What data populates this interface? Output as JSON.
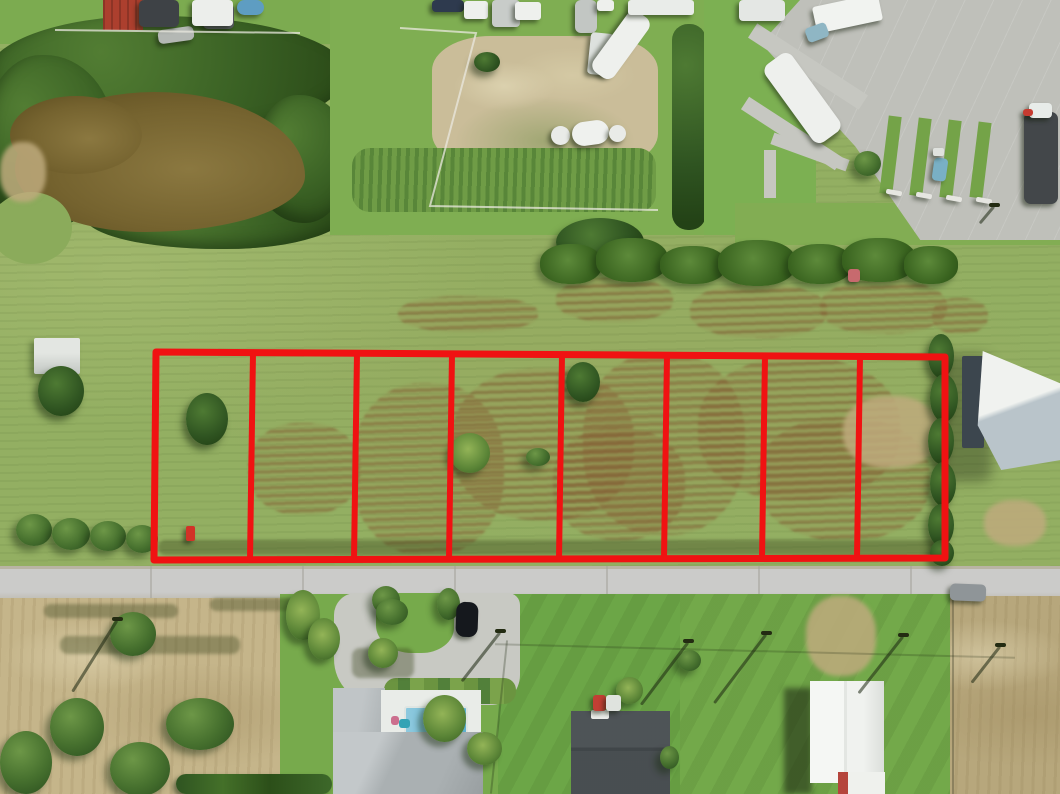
{
  "scene": {
    "subject": "aerial drone photo of grass acreage subdivided into outlined vacant lots along a street",
    "colors": {
      "grass_field": "#93af62",
      "grass_lawn": "#74a94a",
      "road": "#c9c9c6",
      "concrete": "#bfc0ba",
      "pond_water": "#7c6a34",
      "bare_dirt": "#cabd99",
      "dry_field": "#c5b58a",
      "overlay_red": "#f01212",
      "roof_gray": "#aeb3b5",
      "roof_dark": "#878c8f",
      "building_white": "#f2f4f1"
    },
    "overlay": {
      "lot_count": 8,
      "stroke_color": "#f01212",
      "stroke_width": 7,
      "divider_width": 6,
      "outline": {
        "tl": [
          156,
          352
        ],
        "tr": [
          945,
          357
        ],
        "br": [
          945,
          558
        ],
        "bl": [
          154,
          560
        ]
      },
      "divider_xs": [
        253,
        357,
        452,
        562,
        667,
        765,
        860
      ],
      "divider_lean": -3
    },
    "fences": {
      "color": "#e9e8df",
      "lines": [
        "400,28 476,33 430,206 658,210",
        "55,30 300,33"
      ]
    },
    "veg_fields": [
      "name",
      "type",
      "x",
      "y",
      "w",
      "h"
    ],
    "veg": [
      [
        "lot1-tree",
        "dark",
        186,
        393,
        42,
        52
      ],
      [
        "shed-tree",
        "dark",
        38,
        366,
        46,
        50
      ],
      [
        "roadside-bush-1",
        "bush",
        16,
        514,
        36,
        32
      ],
      [
        "roadside-bush-2",
        "bush",
        52,
        518,
        38,
        32
      ],
      [
        "roadside-bush-3",
        "bush",
        90,
        521,
        36,
        30
      ],
      [
        "roadside-bush-4",
        "bush",
        126,
        525,
        32,
        28
      ],
      [
        "lot4-palm",
        "palm",
        450,
        433,
        40,
        40
      ],
      [
        "lot4-bush",
        "bush",
        526,
        448,
        24,
        18
      ],
      [
        "lot5-tree",
        "dark",
        566,
        362,
        34,
        40
      ],
      [
        "hedgerow-tree",
        "dark",
        556,
        218,
        88,
        48
      ],
      [
        "hedgerow-1",
        "hedge",
        540,
        244,
        62,
        40
      ],
      [
        "hedgerow-2",
        "hedge",
        596,
        238,
        72,
        44
      ],
      [
        "hedgerow-3",
        "hedge",
        660,
        246,
        66,
        38
      ],
      [
        "hedgerow-4",
        "hedge",
        718,
        240,
        78,
        46
      ],
      [
        "hedgerow-5",
        "hedge",
        788,
        244,
        64,
        40
      ],
      [
        "hedgerow-6",
        "hedge",
        842,
        238,
        74,
        44
      ],
      [
        "hedgerow-7",
        "hedge",
        904,
        246,
        54,
        38
      ],
      [
        "right-hedge-1",
        "dark",
        928,
        334,
        26,
        44
      ],
      [
        "right-hedge-2",
        "dark",
        930,
        374,
        28,
        48
      ],
      [
        "right-hedge-3",
        "dark",
        928,
        418,
        26,
        46
      ],
      [
        "right-hedge-4",
        "dark",
        930,
        462,
        26,
        44
      ],
      [
        "right-hedge-5",
        "dark",
        928,
        504,
        26,
        42
      ],
      [
        "right-hedge-6",
        "dark",
        930,
        540,
        24,
        26
      ],
      [
        "bottomleft-tree",
        "bush",
        110,
        612,
        46,
        44
      ],
      [
        "bl-bush-1",
        "bush",
        50,
        698,
        54,
        58
      ],
      [
        "bl-bush-2",
        "bush",
        110,
        742,
        60,
        54
      ],
      [
        "bl-bush-3",
        "bush",
        0,
        731,
        52,
        63
      ],
      [
        "bl-bush-4",
        "bush",
        166,
        698,
        68,
        52
      ],
      [
        "bottom-hedgerow",
        "rowdark",
        176,
        774,
        156,
        20
      ],
      [
        "drive-palm-1",
        "palm",
        286,
        590,
        34,
        50
      ],
      [
        "drive-palm-2",
        "palm",
        308,
        618,
        32,
        42
      ],
      [
        "drive-bush-1",
        "bush",
        372,
        586,
        28,
        28
      ],
      [
        "drive-bush-2",
        "bush",
        437,
        588,
        23,
        32
      ],
      [
        "island-bush",
        "bush",
        376,
        599,
        32,
        26
      ],
      [
        "island-palm",
        "palm",
        368,
        638,
        30,
        30
      ],
      [
        "yard-palm-1",
        "palm",
        423,
        695,
        43,
        47
      ],
      [
        "yard-palm-2",
        "palm",
        467,
        732,
        35,
        33
      ],
      [
        "midyard-palm",
        "palm",
        616,
        677,
        27,
        27
      ],
      [
        "midyard-bush",
        "bush",
        660,
        746,
        19,
        23
      ],
      [
        "yard-bush-right",
        "bush",
        678,
        650,
        23,
        21
      ],
      [
        "topright-bush",
        "bush",
        854,
        151,
        27,
        25
      ],
      [
        "enclosure-bush",
        "dark",
        474,
        52,
        26,
        20
      ]
    ],
    "patch_fields": [
      "name",
      "type",
      "x",
      "y",
      "w",
      "h"
    ],
    "patches": [
      [
        "lot23-mow-scar",
        "brown",
        352,
        383,
        152,
        172
      ],
      [
        "lot34-mow-scar",
        "brown",
        452,
        368,
        182,
        152
      ],
      [
        "lot5-mow-scar",
        "brown",
        583,
        353,
        162,
        182
      ],
      [
        "lot67-mow-scar",
        "brown",
        698,
        358,
        202,
        142
      ],
      [
        "lot78-mow-scar",
        "brown",
        758,
        418,
        172,
        122
      ],
      [
        "lot45-mow-scar",
        "brown",
        553,
        428,
        132,
        112
      ],
      [
        "lot2-mow-scar",
        "brown",
        248,
        423,
        112,
        92
      ],
      [
        "lot8-bare-spot",
        "tan",
        843,
        396,
        96,
        72
      ],
      [
        "upper-scar-1",
        "brown",
        556,
        278,
        117,
        44
      ],
      [
        "upper-scar-2",
        "brown",
        690,
        284,
        137,
        54
      ],
      [
        "upper-scar-3",
        "brown",
        820,
        280,
        127,
        54
      ],
      [
        "upper-scar-4",
        "brown",
        932,
        298,
        56,
        36
      ],
      [
        "upper-scar-left",
        "brown",
        398,
        296,
        140,
        36
      ],
      [
        "worn-track",
        "dark",
        158,
        540,
        790,
        15
      ],
      [
        "dryfield-track-1",
        "dark",
        44,
        604,
        134,
        14
      ],
      [
        "dryfield-track-2",
        "dark",
        210,
        598,
        84,
        13
      ],
      [
        "dryfield-track-3",
        "dark",
        60,
        636,
        180,
        18
      ],
      [
        "gravel-drive-right",
        "tan",
        806,
        596,
        70,
        80
      ],
      [
        "righthouse-bare",
        "tan",
        984,
        500,
        62,
        46
      ],
      [
        "pond-bank",
        "tan",
        0,
        142,
        46,
        60
      ],
      [
        "drive-tree-shadow",
        "dark",
        352,
        648,
        62,
        30
      ]
    ],
    "vehicle_fields": [
      "name",
      "x",
      "y",
      "w",
      "h",
      "color",
      "rotation_deg",
      "corner_radius"
    ],
    "vehicles": [
      [
        "parked-black-car",
        456,
        602,
        22,
        35,
        "#15181d",
        2,
        9
      ],
      [
        "car-on-road",
        950,
        584,
        36,
        17,
        "#8f9598",
        2,
        5
      ],
      [
        "teal-cart",
        933,
        158,
        14,
        23,
        "#79b0c5",
        8,
        4
      ],
      [
        "dark-rv",
        1024,
        112,
        34,
        92,
        "#43474a",
        0,
        7
      ],
      [
        "dark-rv-cab",
        1029,
        103,
        23,
        15,
        "#e8ece9",
        0,
        4
      ],
      [
        "red-truck-cab",
        593,
        695,
        13,
        16,
        "#c23f34",
        0,
        3
      ],
      [
        "red-truck-bed",
        606,
        695,
        15,
        16,
        "#dfe3de",
        0,
        3
      ],
      [
        "blue-pool-top",
        237,
        0,
        27,
        15,
        "#5e9dc2",
        0,
        12
      ],
      [
        "gray-van",
        575,
        0,
        22,
        33,
        "#c2c6c3",
        0,
        6
      ],
      [
        "white-box-top",
        597,
        0,
        17,
        11,
        "#eef0ed",
        0,
        3
      ],
      [
        "boat-trailer",
        158,
        28,
        36,
        14,
        "#b4b8b4",
        -8,
        5
      ],
      [
        "yard-equipment-1",
        139,
        0,
        40,
        27,
        "#3e4246",
        0,
        5
      ],
      [
        "yard-equipment-2",
        203,
        4,
        31,
        25,
        "#55595d",
        0,
        5
      ],
      [
        "white-trailer-1",
        192,
        0,
        41,
        26,
        "#eceeeb",
        0,
        4
      ],
      [
        "dark-blue-rv",
        432,
        0,
        32,
        12,
        "#2e3a4e",
        0,
        4
      ],
      [
        "white-rv-1",
        464,
        1,
        24,
        18,
        "#eef0ed",
        0,
        3
      ],
      [
        "gray-rv",
        492,
        0,
        28,
        27,
        "#c8ccc9",
        0,
        4
      ],
      [
        "white-rv-2",
        515,
        2,
        26,
        18,
        "#eef0ed",
        0,
        3
      ],
      [
        "white-box-trailer",
        589,
        33,
        23,
        42,
        "#dde1de",
        6,
        4
      ],
      [
        "angled-white-rv",
        608,
        8,
        26,
        74,
        "#eef0ed",
        36,
        9
      ],
      [
        "white-roof-strip",
        628,
        0,
        66,
        15,
        "#e9ece9",
        0,
        3
      ],
      [
        "topright-trailer",
        739,
        0,
        46,
        21,
        "#e4e7e4",
        0,
        4
      ],
      [
        "topright-rv",
        786,
        50,
        33,
        96,
        "#eef0ed",
        -36,
        9
      ],
      [
        "topright-roof",
        814,
        0,
        67,
        27,
        "#f1f3f0",
        -12,
        3
      ],
      [
        "topright-blue-item",
        806,
        25,
        22,
        15,
        "#8fb6c4",
        -20,
        4
      ],
      [
        "red-item-topright",
        1023,
        109,
        10,
        7,
        "#c63b30",
        0,
        3
      ],
      [
        "parking-curb-1",
        886,
        190,
        16,
        5,
        "#e6e6e1",
        10,
        2
      ],
      [
        "parking-curb-2",
        916,
        193,
        16,
        5,
        "#e6e6e1",
        10,
        2
      ],
      [
        "parking-curb-3",
        946,
        196,
        16,
        5,
        "#e6e6e1",
        10,
        2
      ],
      [
        "parking-curb-4",
        976,
        198,
        16,
        5,
        "#e6e6e1",
        10,
        2
      ],
      [
        "septic-tank-1",
        551,
        126,
        19,
        19,
        "#e9ebe8",
        0,
        50
      ],
      [
        "septic-tank-2",
        572,
        121,
        37,
        24,
        "#eff1ee",
        -8,
        50
      ],
      [
        "septic-tank-3",
        609,
        125,
        17,
        17,
        "#e9ebe8",
        0,
        50
      ],
      [
        "survey-flag",
        186,
        526,
        9,
        15,
        "#d23227",
        0,
        2
      ],
      [
        "pink-marker",
        848,
        269,
        12,
        13,
        "#c76a6e",
        0,
        3
      ],
      [
        "white-spot-concrete",
        933,
        148,
        11,
        8,
        "#dfe2de",
        0,
        2
      ]
    ],
    "pole_fields": [
      "name",
      "x",
      "y",
      "shadow_len",
      "shadow_angle_deg"
    ],
    "poles": [
      [
        "street-pole-1",
        500,
        631,
        62,
        128
      ],
      [
        "street-pole-2",
        688,
        641,
        78,
        127
      ],
      [
        "street-pole-3",
        766,
        633,
        86,
        127
      ],
      [
        "street-pole-4",
        903,
        635,
        72,
        128
      ],
      [
        "street-pole-5",
        1000,
        645,
        46,
        128
      ],
      [
        "field-pole",
        117,
        619,
        84,
        122
      ],
      [
        "lot-lamp",
        994,
        205,
        22,
        130
      ]
    ]
  }
}
